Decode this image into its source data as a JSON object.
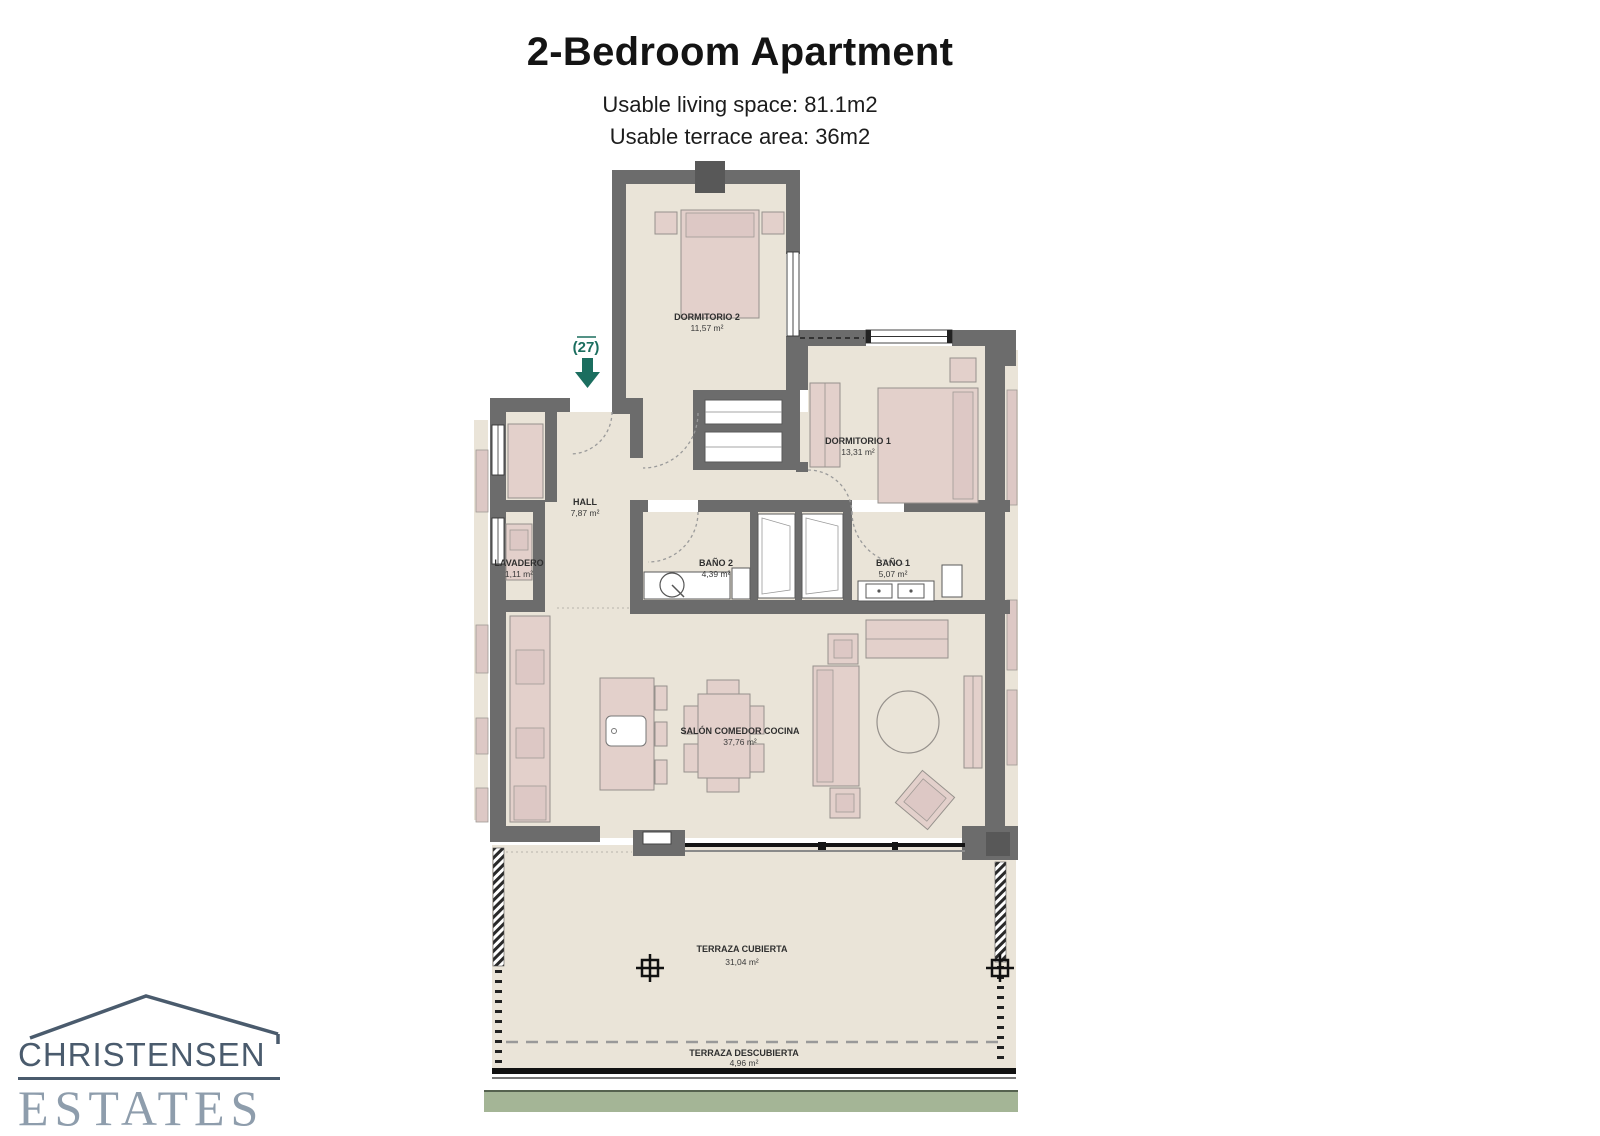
{
  "header": {
    "title": "2-Bedroom Apartment",
    "subtitle_living": "Usable living space: 81.1m2",
    "subtitle_terrace": "Usable terrace area: 36m2"
  },
  "plan": {
    "unit_marker": "(27)",
    "rooms": {
      "dormitorio2": {
        "name": "DORMITORIO 2",
        "area": "11,57 m²"
      },
      "dormitorio1": {
        "name": "DORMITORIO 1",
        "area": "13,31 m²"
      },
      "hall": {
        "name": "HALL",
        "area": "7,87 m²"
      },
      "lavadero": {
        "name": "LAVADERO",
        "area": "1,11 m²"
      },
      "bano2": {
        "name": "BAÑO 2",
        "area": "4,39 m²"
      },
      "bano1": {
        "name": "BAÑO 1",
        "area": "5,07 m²"
      },
      "salon": {
        "name": "SALÓN COMEDOR COCINA",
        "area": "37,76 m²"
      },
      "terraza_cubierta": {
        "name": "TERRAZA CUBIERTA",
        "area": "31,04 m²"
      },
      "terraza_descubierta": {
        "name": "TERRAZA DESCUBIERTA",
        "area": "4,96 m²"
      }
    }
  },
  "logo": {
    "name": "CHRISTENSEN",
    "type": "ESTATES"
  },
  "colors": {
    "wall": "#6c6c6c",
    "floor": "#eae4d8",
    "furniture": "#e3d0cb",
    "furniture_light": "#ddc8c5",
    "accent_teal": "#1b6e5f",
    "brand_dark": "#4a5b6d",
    "brand_light": "#8e9dac",
    "garden_green": "#a4b596"
  }
}
